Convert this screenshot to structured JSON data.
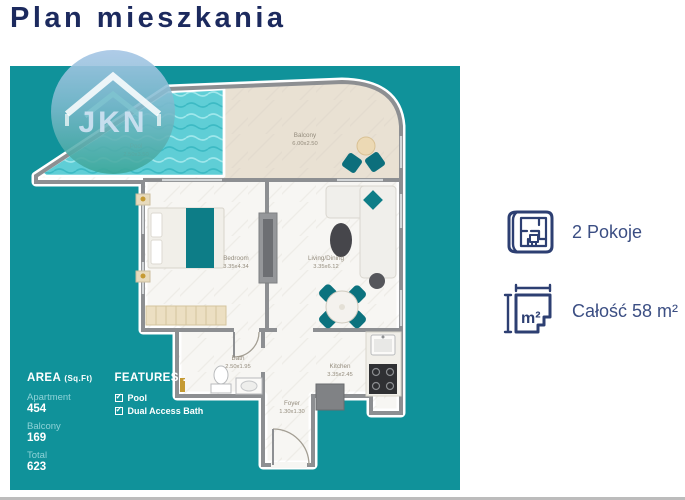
{
  "title": "Plan mieszkania",
  "watermark": {
    "text": "JKN",
    "icon": "house-roof-icon"
  },
  "plan": {
    "rooms": [
      {
        "name": "Pool",
        "dims": "2.50x3.50"
      },
      {
        "name": "Balcony",
        "dims": "6.00x2.50"
      },
      {
        "name": "Bedroom",
        "dims": "3.35x4.34"
      },
      {
        "name": "Living/Dining",
        "dims": "3.35x6.12"
      },
      {
        "name": "Bath",
        "dims": "2.50x1.95"
      },
      {
        "name": "Kitchen",
        "dims": "3.35x2.45"
      },
      {
        "name": "Foyer",
        "dims": "1.30x1.30"
      }
    ],
    "area_panel": {
      "heading": "AREA",
      "heading_unit": "(Sq.Ft)",
      "items": [
        {
          "label": "Apartment",
          "value": "454"
        },
        {
          "label": "Balcony",
          "value": "169"
        },
        {
          "label": "Total",
          "value": "623"
        }
      ]
    },
    "features_panel": {
      "heading": "FEATURES :",
      "items": [
        {
          "label": "Pool"
        },
        {
          "label": "Dual Access Bath"
        }
      ]
    }
  },
  "facts": [
    {
      "icon": "floorplan-icon",
      "label": "2 Pokoje"
    },
    {
      "icon": "area-m2-icon",
      "label": "Całość 58 m²",
      "icon_text": "m²"
    }
  ],
  "colors": {
    "panel_teal": "#10929a",
    "title_navy": "#1c2a5e",
    "fact_navy": "#3b4e83",
    "furniture_teal": "#0d7d87",
    "pool_water": "#5fced6",
    "balcony_floor": "#e9e1d3",
    "wall_gray": "#8d8f92"
  }
}
